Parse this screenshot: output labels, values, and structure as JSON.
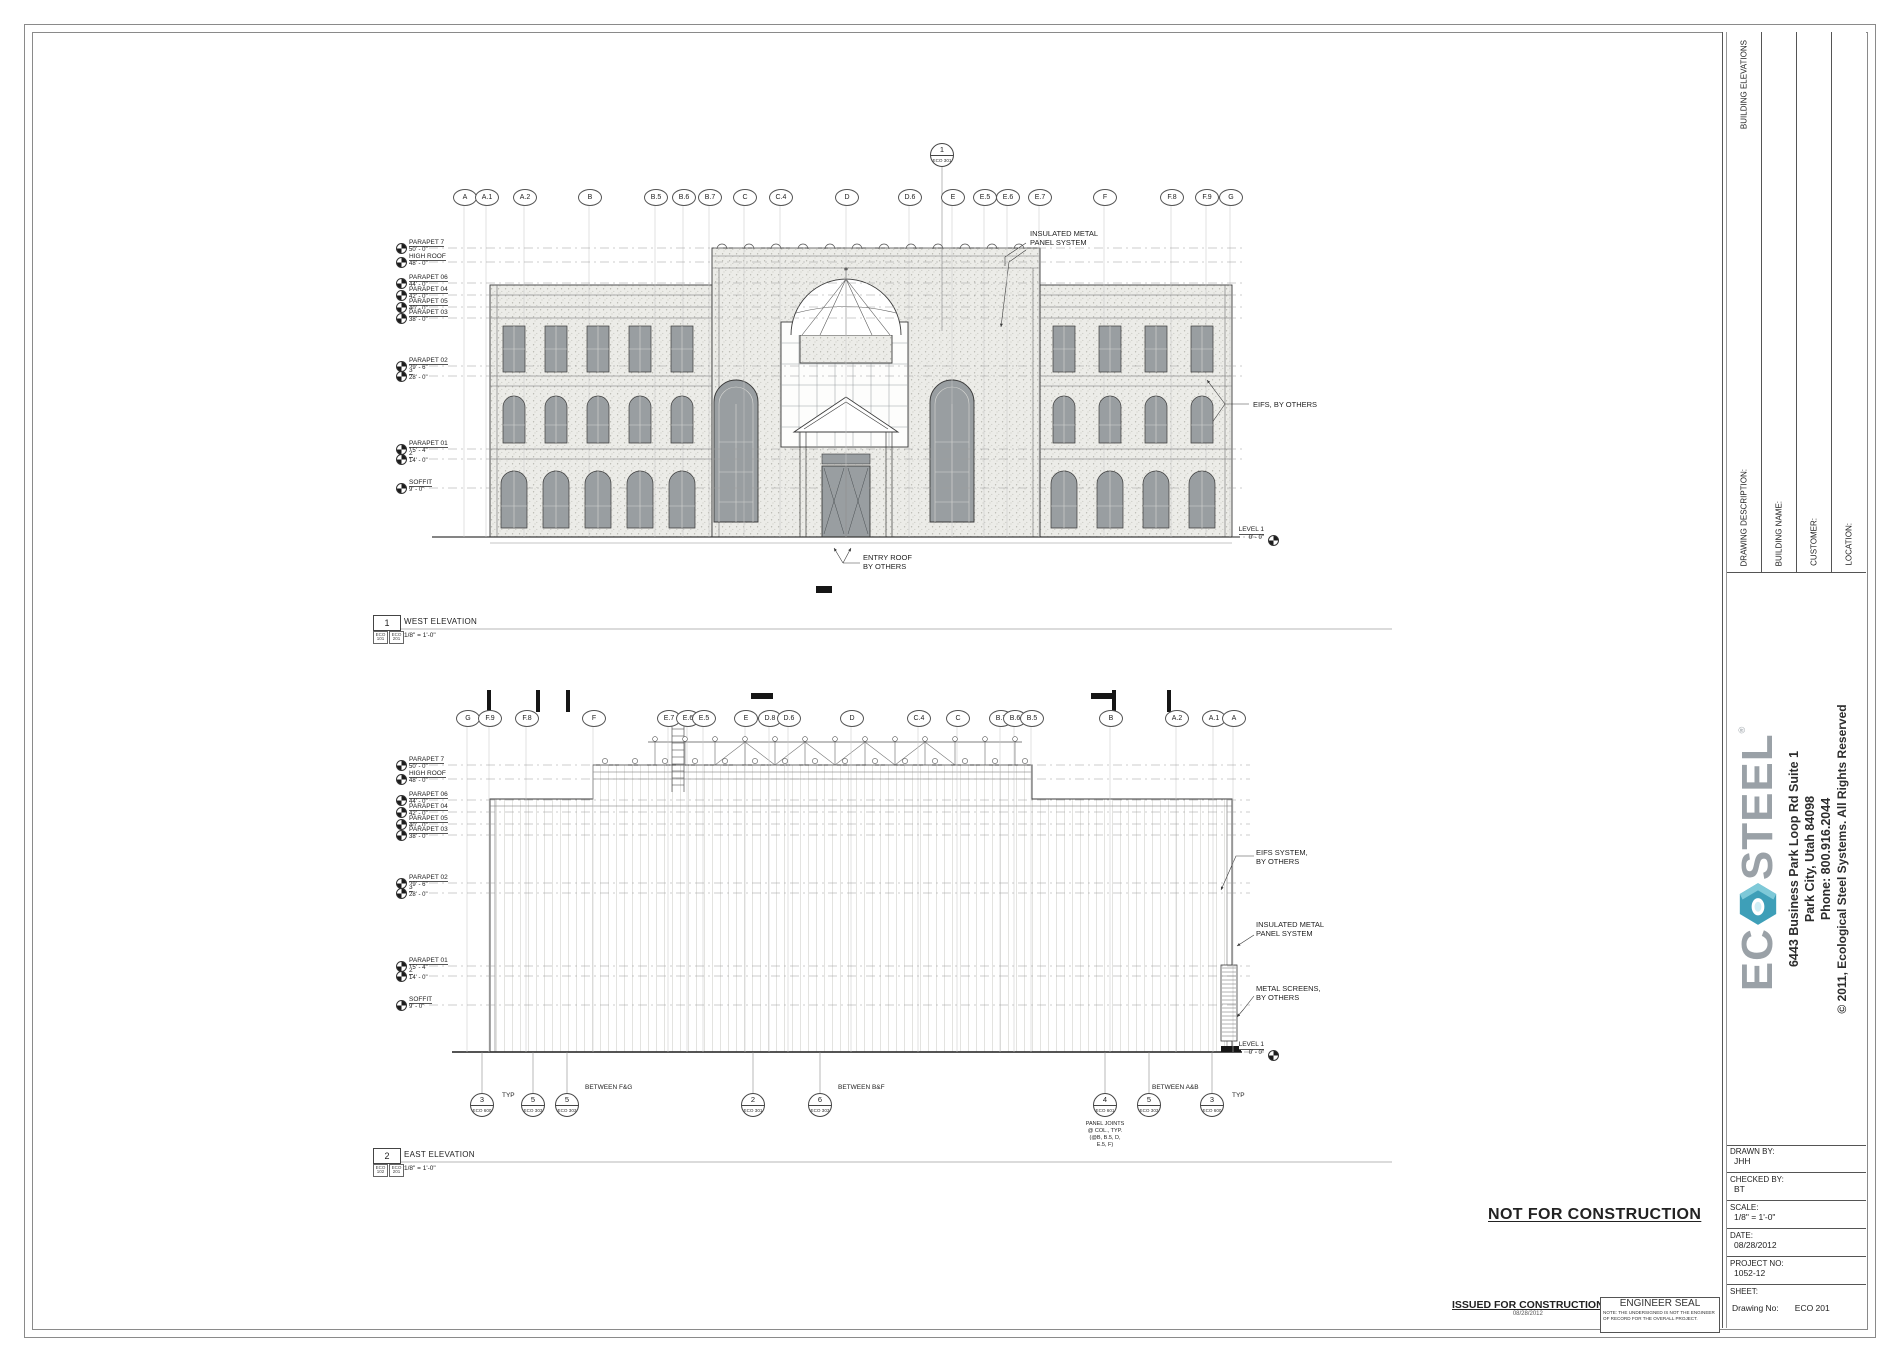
{
  "sheet": {
    "not_for_construction": "NOT FOR CONSTRUCTION",
    "issued_for_construction": "ISSUED FOR CONSTRUCTION",
    "issued_date": "08/28/2012",
    "engineer_seal_title": "ENGINEER SEAL",
    "engineer_seal_note": [
      "NOTE:  THE UNDERSIGNED IS NOT THE ENGINEER",
      "OF RECORD FOR THE OVERALL PROJECT."
    ]
  },
  "titleblock": {
    "vertical_fields": [
      {
        "label": "DRAWING DESCRIPTION:",
        "value": "BUILDING ELEVATIONS"
      },
      {
        "label": "BUILDING NAME:",
        "value": ""
      },
      {
        "label": "CUSTOMER:",
        "value": ""
      },
      {
        "label": "LOCATION:",
        "value": ""
      }
    ],
    "logo_ec": "EC",
    "logo_steel": "STEEL",
    "logo_reg": "®",
    "address_lines": [
      "6443 Business Park Loop Rd Suite 1",
      "Park City, Utah 84098",
      "Phone: 800.916.2044"
    ],
    "copyright": "© 2011, Ecological Steel Systems. All Rights Reserved",
    "fields": [
      {
        "label": "DRAWN BY:",
        "value": "JHH"
      },
      {
        "label": "CHECKED BY:",
        "value": "BT"
      },
      {
        "label": "SCALE:",
        "value": "1/8\" = 1'-0\""
      },
      {
        "label": "DATE:",
        "value": "08/28/2012"
      },
      {
        "label": "PROJECT NO:",
        "value": "1052-12"
      }
    ],
    "sheet_label": "SHEET:",
    "drawing_no_label": "Drawing No:",
    "drawing_no": "ECO 201"
  },
  "west": {
    "title": {
      "num": "1",
      "label": "WEST ELEVATION",
      "scale": "1/8\" = 1'-0\"",
      "refs": [
        "ECO 101",
        "ECO 201"
      ]
    },
    "callout": {
      "num": "1",
      "sheet": "ECO 301"
    },
    "grid_bubbles": [
      {
        "label": "A",
        "x": 464
      },
      {
        "label": "A.1",
        "x": 486
      },
      {
        "label": "A.2",
        "x": 524
      },
      {
        "label": "B",
        "x": 589
      },
      {
        "label": "B.5",
        "x": 655
      },
      {
        "label": "B.6",
        "x": 683
      },
      {
        "label": "B.7",
        "x": 709
      },
      {
        "label": "C",
        "x": 744
      },
      {
        "label": "C.4",
        "x": 780
      },
      {
        "label": "D",
        "x": 846
      },
      {
        "label": "D.6",
        "x": 909
      },
      {
        "label": "E",
        "x": 952
      },
      {
        "label": "E.5",
        "x": 984
      },
      {
        "label": "E.6",
        "x": 1007
      },
      {
        "label": "E.7",
        "x": 1039
      },
      {
        "label": "F",
        "x": 1104
      },
      {
        "label": "F.8",
        "x": 1171
      },
      {
        "label": "F.9",
        "x": 1206
      },
      {
        "label": "G",
        "x": 1230
      }
    ],
    "levels": [
      {
        "name": "PARAPET 7",
        "elev": "50' - 0\"",
        "y": 248
      },
      {
        "name": "HIGH ROOF",
        "elev": "48' - 0\"",
        "y": 262
      },
      {
        "name": "PARAPET 06",
        "elev": "44' - 0\"",
        "y": 283
      },
      {
        "name": "PARAPET 04",
        "elev": "42' - 0\"",
        "y": 295
      },
      {
        "name": "PARAPET 05",
        "elev": "40' - 0\"",
        "y": 307
      },
      {
        "name": "PARAPET 03",
        "elev": "38' - 0\"",
        "y": 318
      },
      {
        "name": "PARAPET 02",
        "elev": "29' - 6\"",
        "y": 366
      },
      {
        "name": "3",
        "elev": "28' - 0\"",
        "y": 376
      },
      {
        "name": "PARAPET 01",
        "elev": "15' - 4\"",
        "y": 449
      },
      {
        "name": "2",
        "elev": "14' - 0\"",
        "y": 459
      },
      {
        "name": "SOFFIT",
        "elev": "9' - 0\"",
        "y": 488
      }
    ],
    "annotations": {
      "panel_system": [
        "INSULATED METAL",
        "PANEL SYSTEM"
      ],
      "eifs": [
        "EIFS, BY OTHERS"
      ],
      "entry_roof": [
        "ENTRY ROOF",
        "BY OTHERS"
      ]
    },
    "level1": {
      "name": "LEVEL 1",
      "elev": "0' - 0\""
    }
  },
  "east": {
    "title": {
      "num": "2",
      "label": "EAST ELEVATION",
      "scale": "1/8\" = 1'-0\"",
      "refs": [
        "ECO 102",
        "ECO 201"
      ]
    },
    "grid_bubbles": [
      {
        "label": "G",
        "x": 467
      },
      {
        "label": "F.9",
        "x": 489
      },
      {
        "label": "F.8",
        "x": 526
      },
      {
        "label": "F",
        "x": 593
      },
      {
        "label": "E.7",
        "x": 668
      },
      {
        "label": "E.6",
        "x": 687
      },
      {
        "label": "E.5",
        "x": 703
      },
      {
        "label": "E",
        "x": 745
      },
      {
        "label": "D.8",
        "x": 769
      },
      {
        "label": "D.6",
        "x": 788
      },
      {
        "label": "D",
        "x": 851
      },
      {
        "label": "C.4",
        "x": 918
      },
      {
        "label": "C",
        "x": 957
      },
      {
        "label": "B.7",
        "x": 1000
      },
      {
        "label": "B.6",
        "x": 1014
      },
      {
        "label": "B.5",
        "x": 1031
      },
      {
        "label": "B",
        "x": 1110
      },
      {
        "label": "A.2",
        "x": 1176
      },
      {
        "label": "A.1",
        "x": 1213
      },
      {
        "label": "A",
        "x": 1233
      }
    ],
    "levels": [
      {
        "name": "PARAPET 7",
        "elev": "50' - 0\"",
        "y": 765
      },
      {
        "name": "HIGH ROOF",
        "elev": "48' - 0\"",
        "y": 779
      },
      {
        "name": "PARAPET 06",
        "elev": "44' - 0\"",
        "y": 800
      },
      {
        "name": "PARAPET 04",
        "elev": "42' - 0\"",
        "y": 812
      },
      {
        "name": "PARAPET 05",
        "elev": "40' - 0\"",
        "y": 824
      },
      {
        "name": "PARAPET 03",
        "elev": "38' - 0\"",
        "y": 835
      },
      {
        "name": "PARAPET 02",
        "elev": "29' - 6\"",
        "y": 883
      },
      {
        "name": "3",
        "elev": "28' - 0\"",
        "y": 893
      },
      {
        "name": "PARAPET 01",
        "elev": "15' - 4\"",
        "y": 966
      },
      {
        "name": "2",
        "elev": "14' - 0\"",
        "y": 976
      },
      {
        "name": "SOFFIT",
        "elev": "9' - 0\"",
        "y": 1005
      }
    ],
    "annotations": {
      "eifs_system": [
        "EIFS SYSTEM,",
        "BY OTHERS"
      ],
      "panel_system": [
        "INSULATED METAL",
        "PANEL SYSTEM"
      ],
      "metal_screens": [
        "METAL SCREENS,",
        "BY OTHERS"
      ]
    },
    "level1": {
      "name": "LEVEL 1",
      "elev": "0' - 0\""
    },
    "callouts": [
      {
        "num": "3",
        "sheet": "ECO 600",
        "x": 482,
        "label": "TYP",
        "lx": 502,
        "ly": 1092
      },
      {
        "num": "5",
        "sheet": "ECO 303",
        "x": 533
      },
      {
        "num": "5",
        "sheet": "ECO 303",
        "x": 567,
        "label": "BETWEEN F&G",
        "lx": 585,
        "ly": 1084
      },
      {
        "num": "2",
        "sheet": "ECO 301",
        "x": 753
      },
      {
        "num": "6",
        "sheet": "ECO 303",
        "x": 820,
        "label": "BETWEEN B&F",
        "lx": 838,
        "ly": 1084
      },
      {
        "num": "4",
        "sheet": "ECO 601",
        "x": 1105
      },
      {
        "num": "5",
        "sheet": "ECO 303",
        "x": 1149,
        "label": "BETWEEN A&B",
        "lx": 1152,
        "ly": 1084
      },
      {
        "num": "3",
        "sheet": "ECO 600",
        "x": 1212,
        "label": "TYP",
        "lx": 1232,
        "ly": 1092
      }
    ],
    "panel_note": [
      "PANEL JOINTS",
      "@ COL., TYP.",
      "(@B, B.5, D,",
      "E.5, F)"
    ]
  }
}
